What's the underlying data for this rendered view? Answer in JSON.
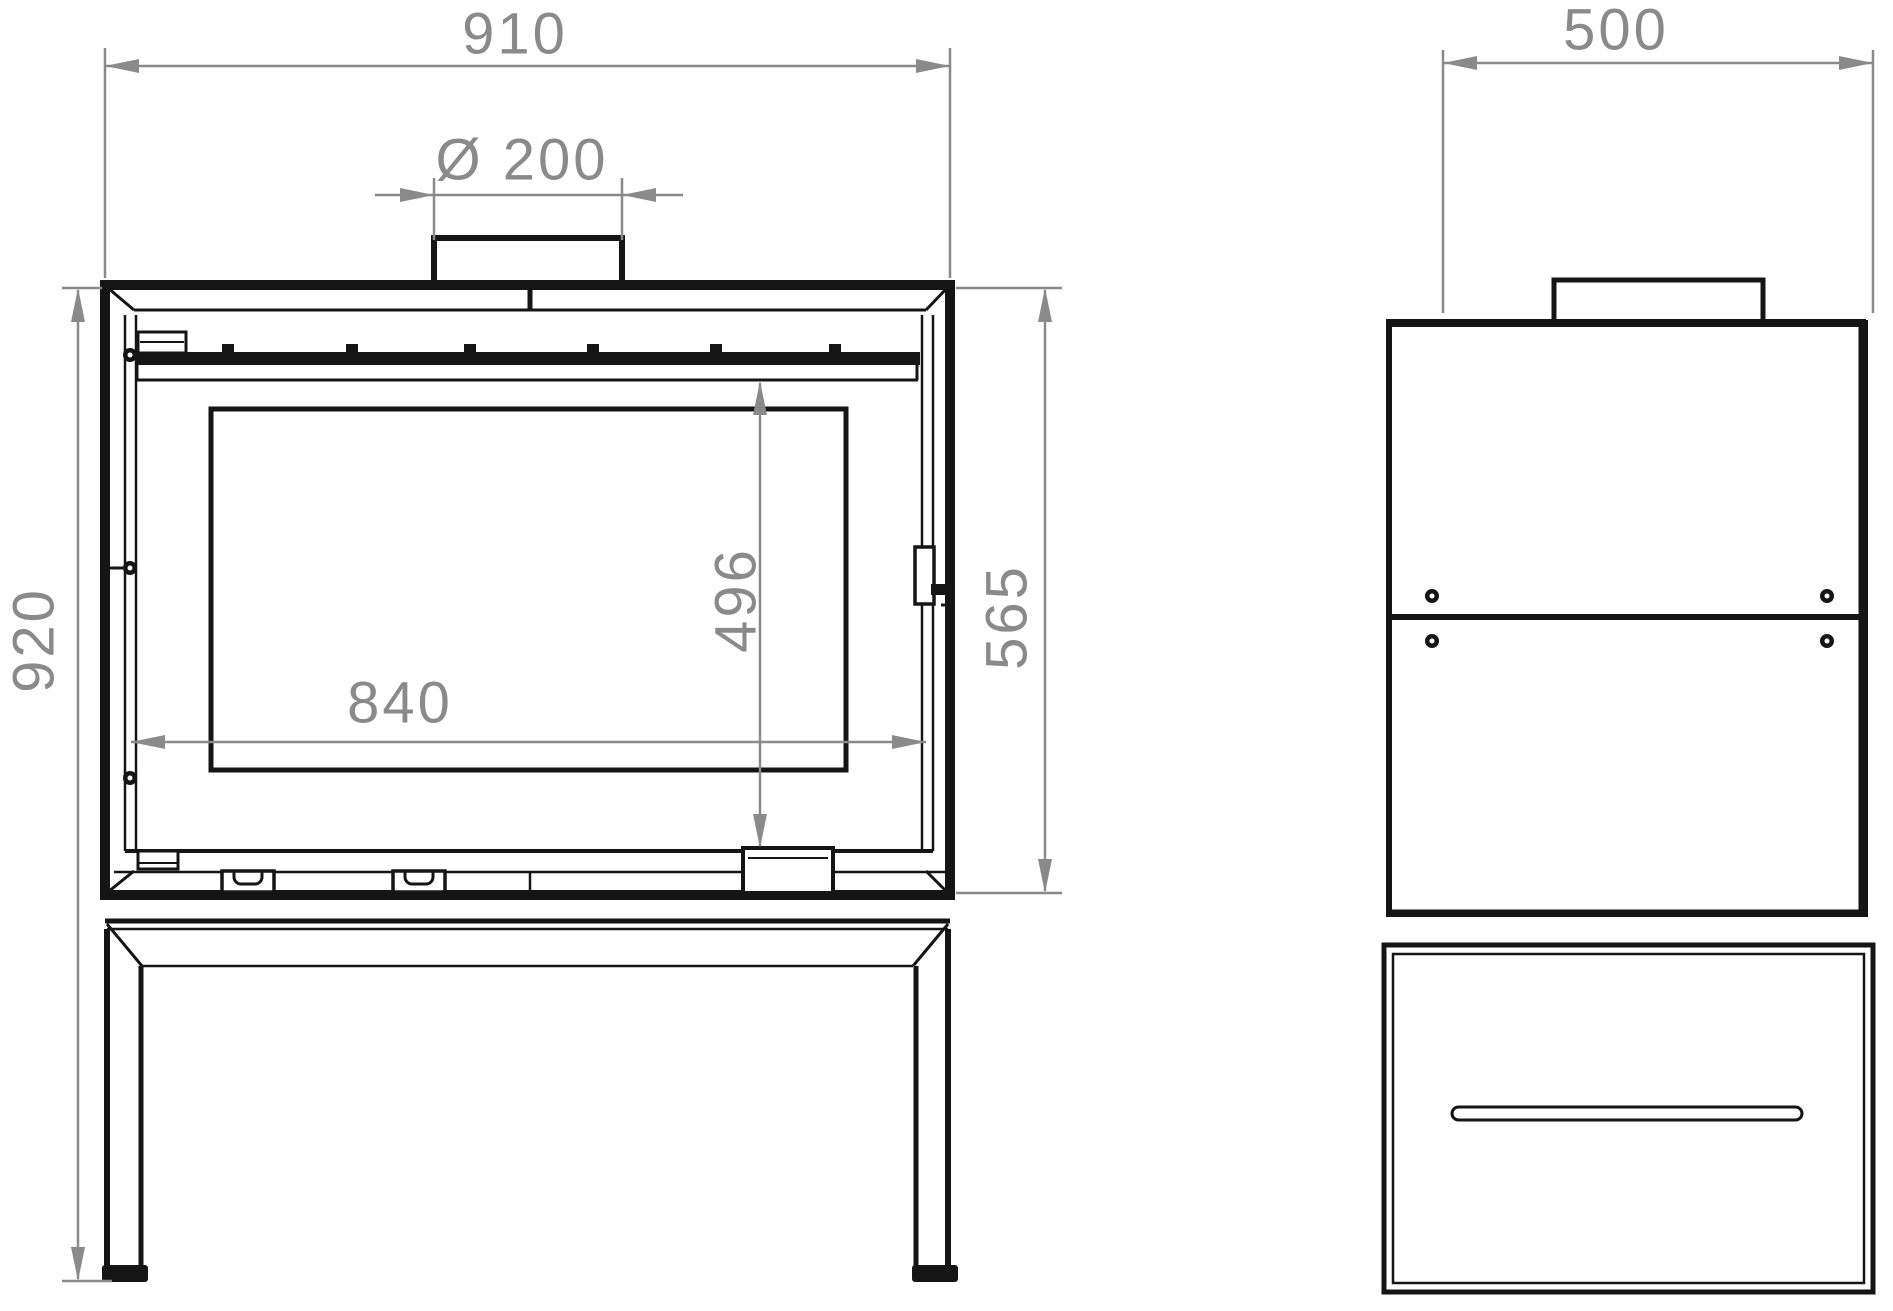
{
  "drawing": {
    "kind": "stove-technical-drawing-front-and-side-views",
    "line_color": "#151515",
    "dimension_color": "#8a8a8a",
    "dimensions": {
      "overall_width": "910",
      "flue_diameter": "Ø 200",
      "overall_height": "920",
      "body_height": "565",
      "glass_height": "496",
      "glass_width": "840",
      "depth": "500"
    }
  }
}
